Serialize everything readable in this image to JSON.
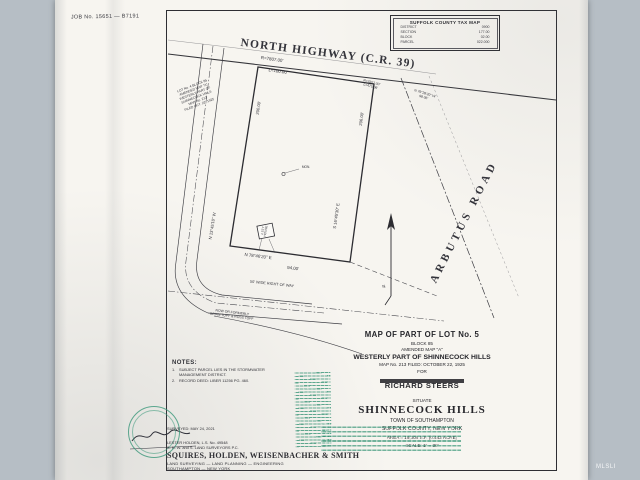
{
  "meta": {
    "job_number": "JOB No. 15651 — B7191",
    "watermark": "MLSLI",
    "stamp_color": "#2f8f72"
  },
  "tax_map_box": {
    "title": "SUFFOLK COUNTY TAX MAP",
    "rows": [
      {
        "label": "DISTRICT",
        "value": "0900"
      },
      {
        "label": "SECTION",
        "value": "177.00"
      },
      {
        "label": "BLOCK",
        "value": "02.00"
      },
      {
        "label": "PARCEL",
        "value": "022.000"
      }
    ]
  },
  "drawing": {
    "highway_name": "NORTH  HIGHWAY  (C.R.  39)",
    "frontage_radius": "R=7807.00'",
    "frontage_arc": "L=100.00'",
    "arbutus_curve_radius": "R=7807.00'",
    "arbutus_curve_arc": "L=475.06'",
    "ne_bearing": "N 79°28'20\" W",
    "ne_distance": "98.06'",
    "arbutus_road": "ARBUTUS  ROAD",
    "west_line_distance": "200.00'",
    "west_line_bearing": "N 13°45'10\" W",
    "east_line_distance": "206.00'",
    "east_line_bearing": "S 16°45'30\" E",
    "south_line_bearing": "N 78°46'20\" E",
    "south_line_distance": "94.00'",
    "right_of_way_label": "50' WIDE RIGHT OF WAY",
    "now_or_formerly_1": "NOW OR FORMERLY",
    "now_or_formerly_2": "BRIAN TOPF & ROSS TOPF",
    "monument_label": "MON.",
    "house_label_1": "1 STY",
    "house_label_2": "HOUSE",
    "north_label": "N",
    "adjacent_lot_lines": [
      "LOT No. 4  BLOCK 85",
      "AMENDED MAP \"A\"",
      "WESTERLY PART OF",
      "SHINNECOCK HILLS",
      "MAP No. 213",
      "FILED OCT. 22, 1925"
    ]
  },
  "title_block": {
    "line1": "MAP  OF  PART  OF  LOT  No.  5",
    "line2": "BLOCK  85",
    "line3": "AMENDED  MAP  \"A\"",
    "line4": "WESTERLY  PART  OF  SHINNECOCK  HILLS",
    "line5": "MAP  No.  213     FILED:  OCTOBER  22,  1925",
    "for_label": "FOR",
    "client": "RICHARD  STEERS",
    "situate": "SITUATE",
    "place": "SHINNECOCK  HILLS",
    "town": "TOWN  OF  SOUTHAMPTON",
    "county": "SUFFOLK  COUNTY,  NEW  YORK",
    "area": "AREA  =  19,308  S.F.  (0.443  ACRE)",
    "scale": "SCALE:  1\" = 30'"
  },
  "notes": {
    "heading": "NOTES:",
    "item1_num": "1.",
    "item1_text": "SUBJECT PARCEL LIES IN THE STORMWATER MANAGEMENT DISTRICT.",
    "item2_num": "2.",
    "item2_text": "RECORD DEED: LIBER 11256 PG. 460."
  },
  "firm": {
    "surveyed": "SURVEYED: MAY 24, 2021",
    "license": "LESTER HOLDEN,  L.S. No. 49548",
    "surveyors_pc": "S. H. W. and S.  LAND SURVEYORS P.C.",
    "name": "SQUIRES,  HOLDEN,  WEISENBACHER  &  SMITH",
    "services": "LAND SURVEYING — LAND PLANNING — ENGINEERING",
    "location": "SOUTHAMPTON — NEW YORK"
  }
}
